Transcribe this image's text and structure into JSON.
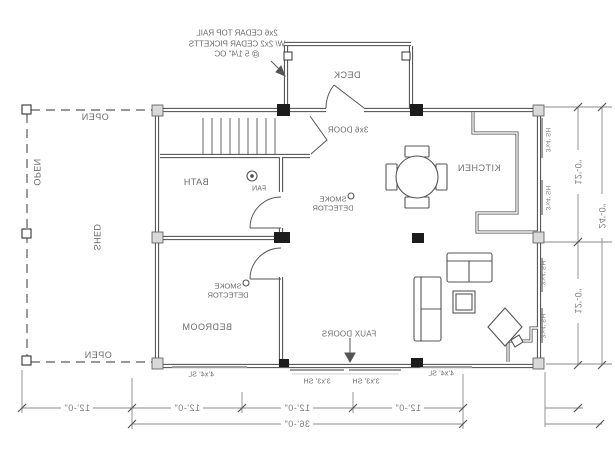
{
  "drawing_title": "floor plan",
  "colors": {
    "background": "#ffffff",
    "wall_line": "#474747",
    "detail_line": "#555555",
    "dimension_line": "#8a8a8a",
    "text": "#6b6b6b",
    "post_fill": "#1c1c1c",
    "window_mark": "#9e9e9e"
  },
  "note": {
    "line1": "2x6 CEDAR TOP RAIL",
    "line2": "W/ 2x2 CEDAR PICKETTS",
    "line3": "@ 5 1/4\" OC"
  },
  "rooms": {
    "deck": "DECK",
    "kitchen": "KITCHEN",
    "bath": "BATH",
    "bedroom": "BEDROOM",
    "shed": "SHED"
  },
  "open_labels": {
    "top": "OPEN",
    "left": "OPEN",
    "bottom": "OPEN"
  },
  "fixtures": {
    "deck_door": "3x6 DOOR",
    "fan": "FAN",
    "smoke_line1": "SMOKE",
    "smoke_line2": "DETECTOR",
    "smoke_symbol": "○",
    "faux_doors": "FAUX DOORS"
  },
  "window_tags": {
    "bottom_left_slider": "4'x4' SL",
    "bottom_right_slider": "4'x4' SL",
    "faux_left": "3'x3' SH",
    "faux_right": "3'x3' SH",
    "side_1": "3'x4' SH",
    "side_2": "3'x4' SH",
    "side_3": "3'x4' SH",
    "side_4": "3'x4' SH"
  },
  "dims": {
    "bottom": [
      "12'-0\"",
      "12'-0\"",
      "12'-0\"",
      "12'-0\""
    ],
    "bottom_total": "36'-0\"",
    "right": [
      "12'-0\"",
      "12'-0\""
    ],
    "right_total": "24'-0\""
  }
}
